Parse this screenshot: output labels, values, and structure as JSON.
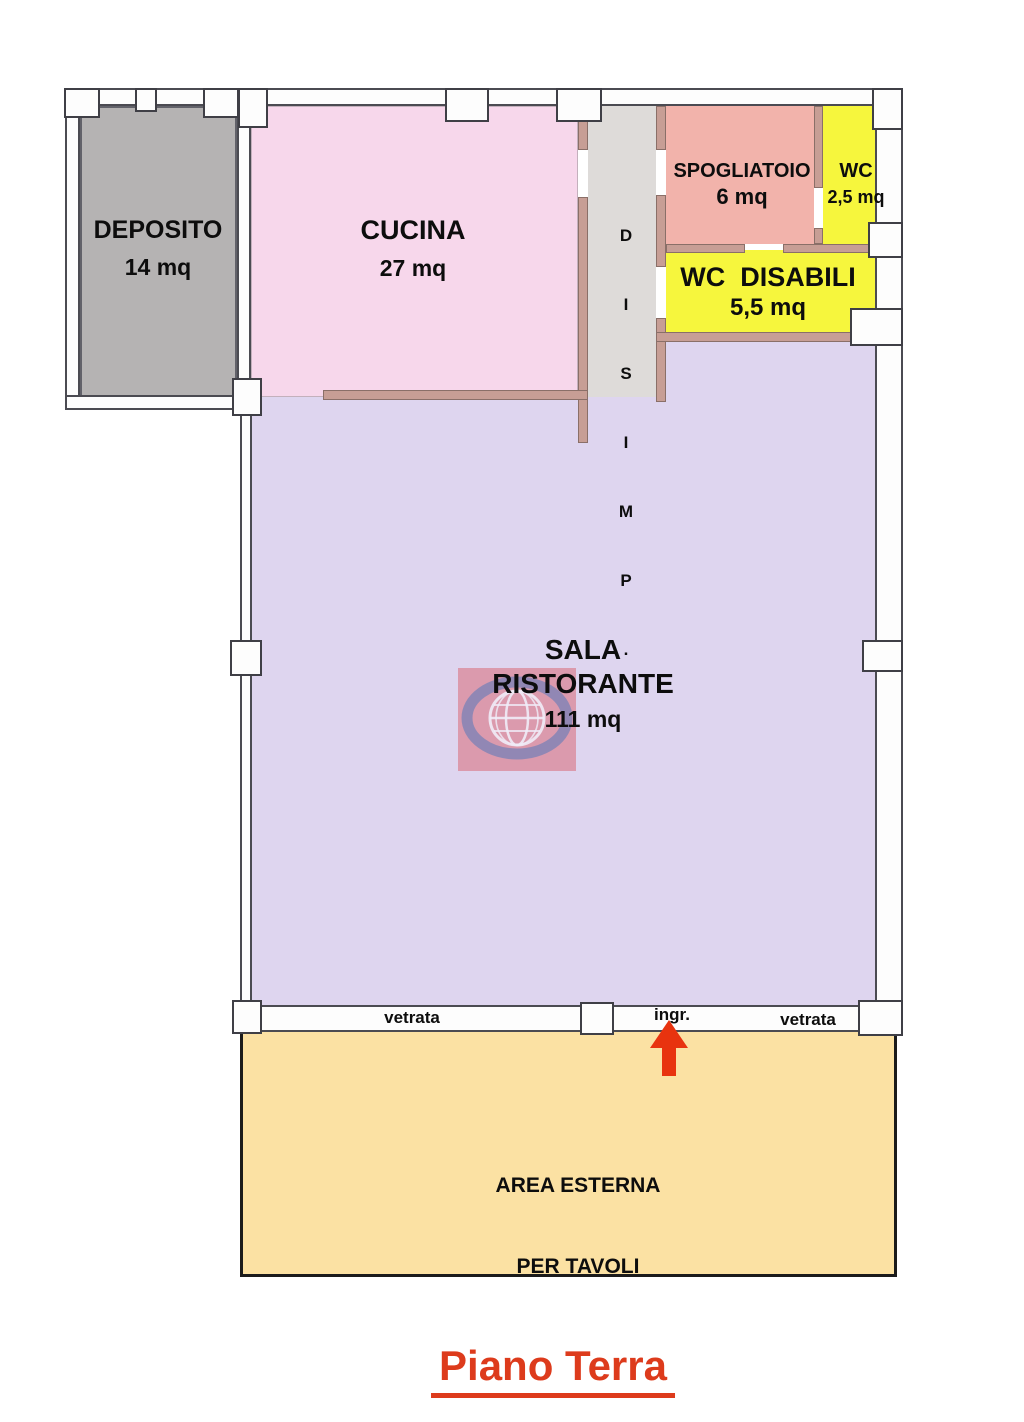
{
  "page": {
    "title": "Piano Terra",
    "title_color": "#dd3b1c"
  },
  "rooms": {
    "deposito": {
      "name": "DEPOSITO",
      "area": "14 mq",
      "color": "#b5b3b3"
    },
    "cucina": {
      "name": "CUCINA",
      "area": "27 mq",
      "color": "#f7d7eb"
    },
    "disimpegno": {
      "letters": [
        "D",
        "I",
        "S",
        "I",
        "M",
        "P",
        "."
      ],
      "color": "#dedbd9"
    },
    "spogliatoio": {
      "name": "SPOGLIATOIO",
      "area": "6 mq",
      "color": "#f2b3ab"
    },
    "wc": {
      "name": "WC",
      "area": "2,5 mq",
      "color": "#f6f63d"
    },
    "wc_disabili": {
      "name": "WC  DISABILI",
      "area": "5,5 mq",
      "color": "#f6f63d"
    },
    "sala_ristorante": {
      "name_line1": "SALA",
      "name_line2": "RISTORANTE",
      "area": "111 mq",
      "color": "#ded5ef"
    },
    "area_esterna": {
      "name_line1": "AREA ESTERNA",
      "name_line2": "PER TAVOLI",
      "color": "#fbe1a3"
    }
  },
  "annotations": {
    "vetrata_left": "vetrata",
    "ingresso": "ingr.",
    "vetrata_right": "vetrata"
  },
  "graphics": {
    "entrance_arrow_color": "#e8330f",
    "interior_wall_color": "#c79e95",
    "exterior_wall_color": "#fdfdfd",
    "watermark": "globe-logo"
  }
}
